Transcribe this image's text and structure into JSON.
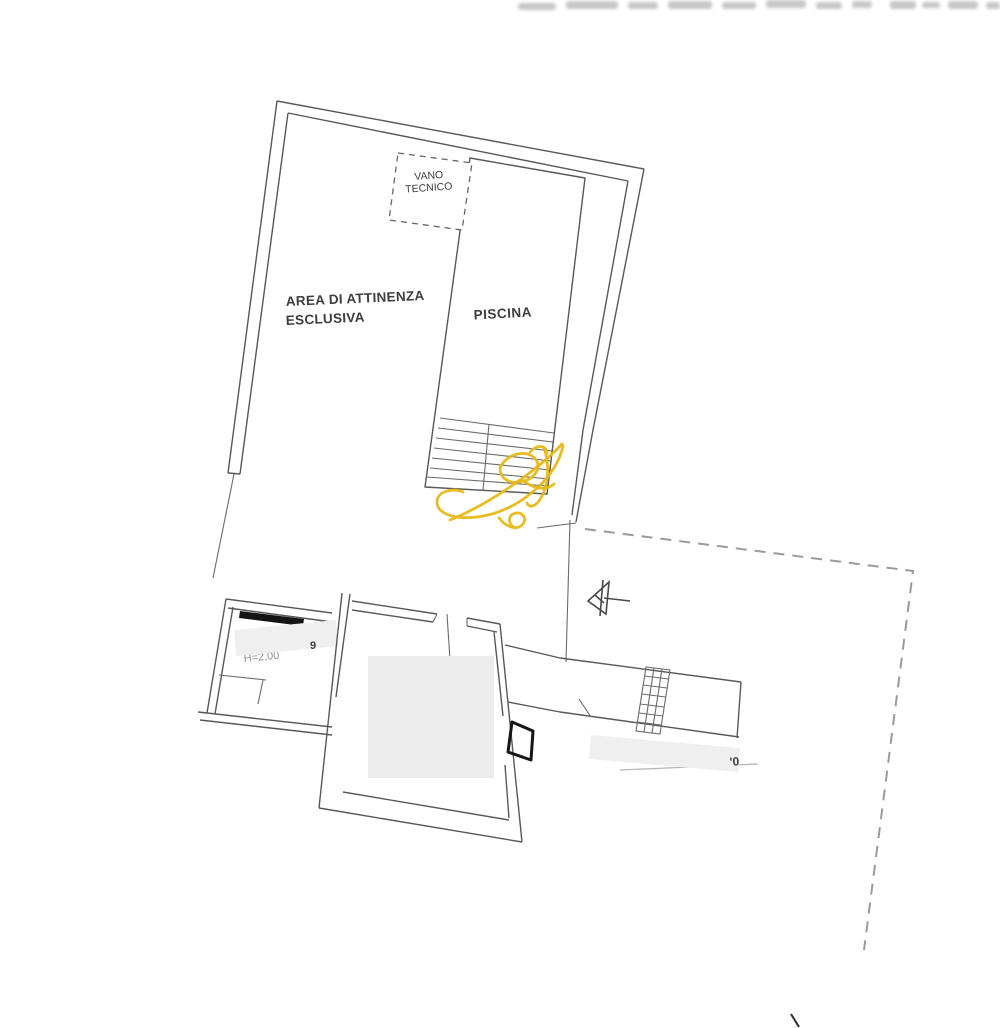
{
  "labels": {
    "area_line1": "AREA DI ATTINENZA",
    "area_line2": "ESCLUSIVA",
    "piscina": "PISCINA",
    "vano_line1": "VANO",
    "vano_line2": "TECNICO",
    "height_note": "H=2,00",
    "room_number": "9",
    "covered_fragment": "'0"
  },
  "colors": {
    "line": "#585858",
    "dashed_boundary": "#9a9a9a",
    "watermark": "#e7b917",
    "redaction_fill": "#efefef",
    "room_fill": "#ececec",
    "window_bar": "#141414"
  }
}
